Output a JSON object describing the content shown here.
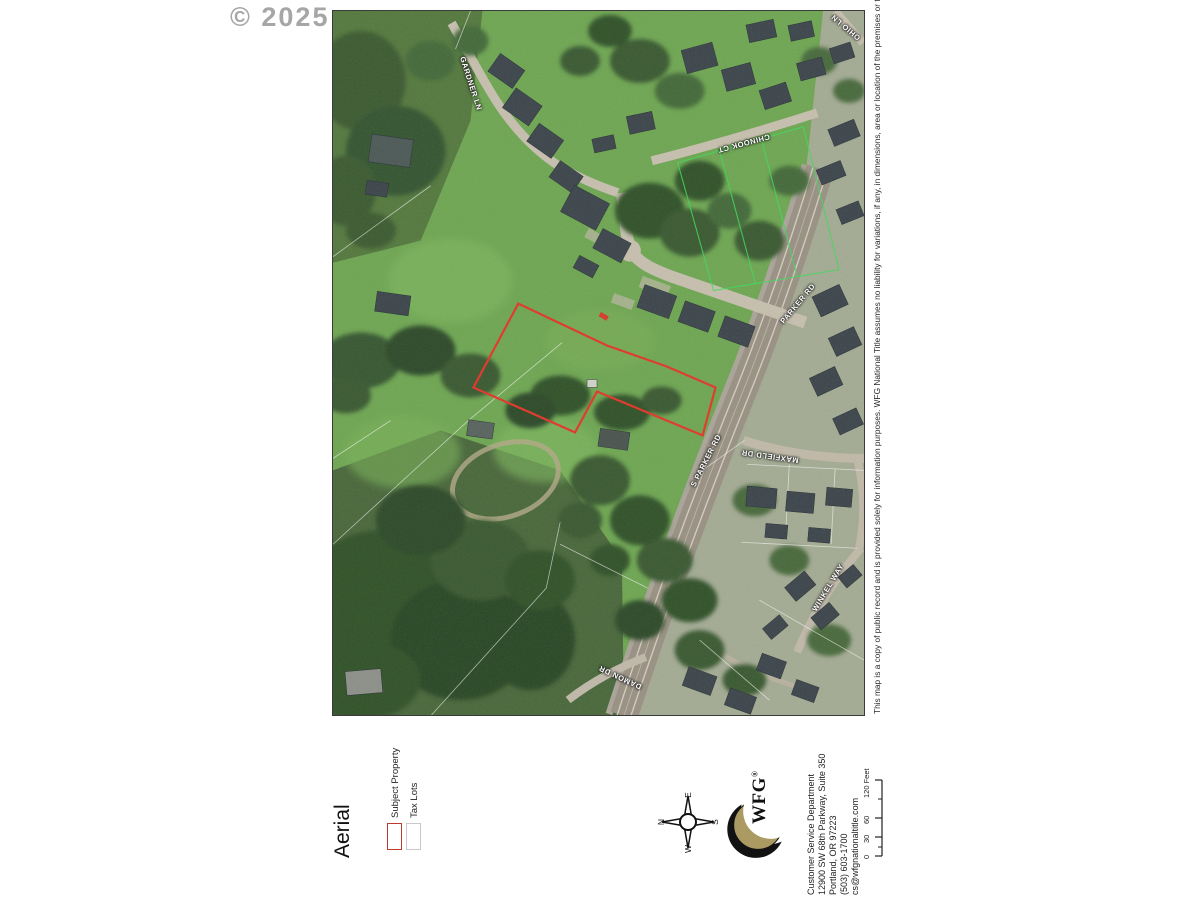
{
  "watermark": "© 2025",
  "map": {
    "streets": [
      {
        "id": "gardner-ln",
        "name": "GARDNER LN"
      },
      {
        "id": "chinook-ct",
        "name": "CHINOOK CT"
      },
      {
        "id": "parker-rd",
        "name": "PARKER RD"
      },
      {
        "id": "s-parker-rd",
        "name": "S PARKER RD"
      },
      {
        "id": "maxfield-dr",
        "name": "MAXFIELD DR"
      },
      {
        "id": "winkel-way",
        "name": "WINKEL WAY"
      },
      {
        "id": "damon-dr",
        "name": "DAMON DR"
      },
      {
        "id": "ohio-ln",
        "name": "OHIO LN"
      }
    ],
    "colors": {
      "subject_outline": "#e0382a",
      "tax_lot_outline": "#c9c9c9",
      "bright_lot_line": "#3fd95b"
    }
  },
  "disclaimer": "This map is a copy of public record and is provided solely for information purposes. WFG National Title assumes no liability for variations, if any, in dimensions, area or location of the premises or the location of improvements.",
  "footer": {
    "map_title": "Aerial",
    "legend": [
      {
        "label": "Subject Property",
        "color": "#c0392b"
      },
      {
        "label": "Tax Lots",
        "color": "#c9c9c9"
      }
    ],
    "compass": {
      "n": "N",
      "e": "E",
      "s": "S",
      "w": "W"
    },
    "logo": {
      "text": "WFG",
      "reg": "®",
      "gold": "#ab9b62"
    },
    "address_lines": [
      "Customer Service Department",
      "12900 SW 68th Parkway, Suite 350",
      "Portland, OR 97223",
      "(503) 603-1700",
      "cs@wfgnationaltitle.com"
    ],
    "scale": {
      "ticks": [
        "0",
        "30",
        "60",
        "120 Feet"
      ]
    }
  }
}
